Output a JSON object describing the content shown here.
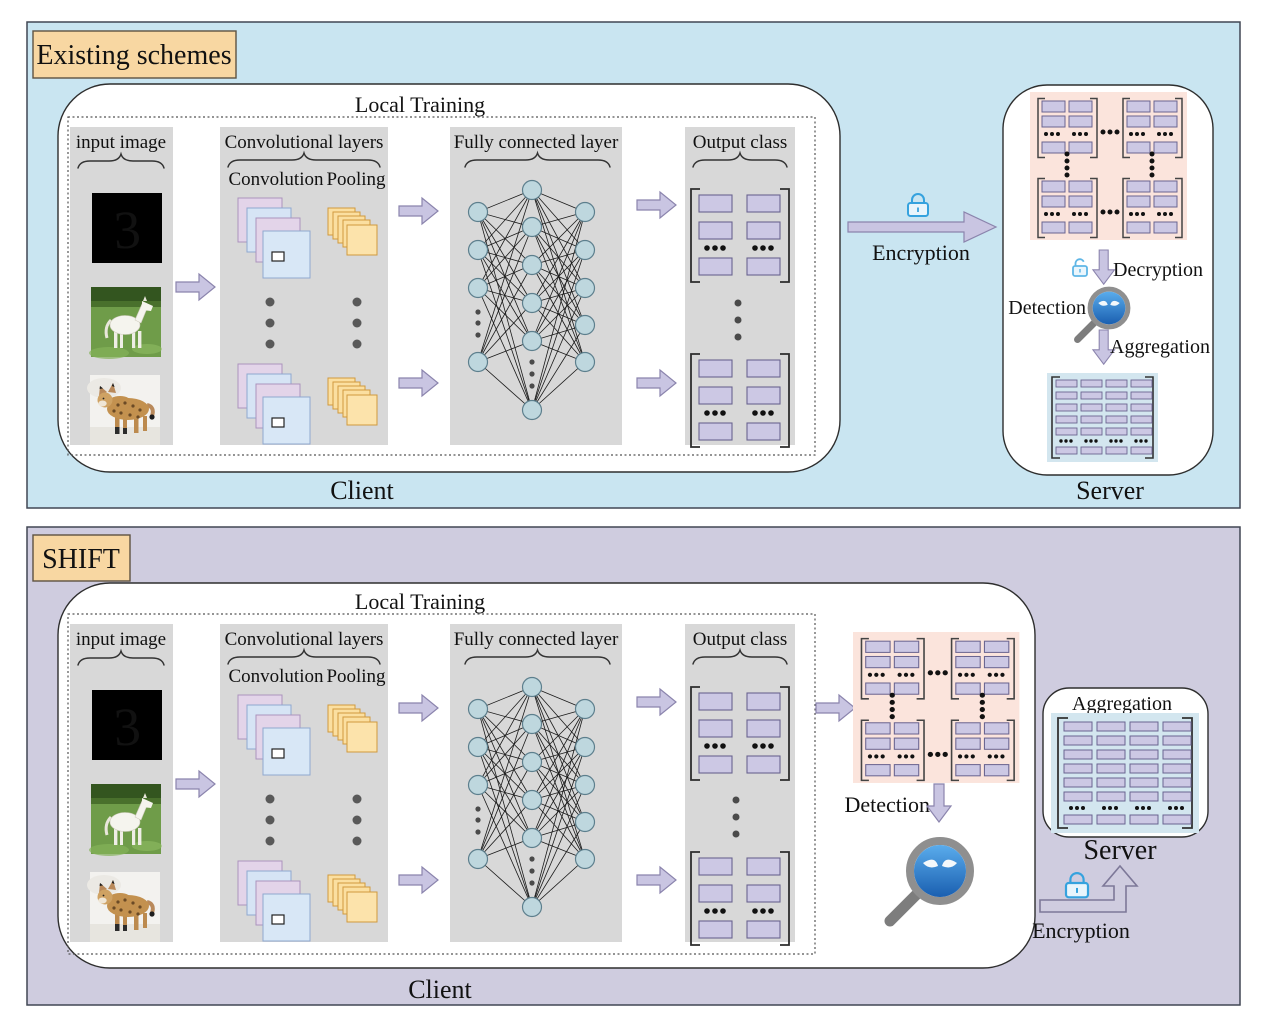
{
  "shared": {
    "mnist_digit": "3"
  },
  "panel1": {
    "tag": "Existing schemes",
    "local_training": "Local Training",
    "input_image": "input image",
    "conv_layers": "Convolutional layers",
    "convolution": "Convolution",
    "pooling": "Pooling",
    "fc_layer": "Fully connected layer",
    "output_class": "Output class",
    "client": "Client",
    "encryption": "Encryption",
    "decryption": "Decryption",
    "detection": "Detection",
    "aggregation": "Aggregation",
    "server": "Server"
  },
  "panel2": {
    "tag": "SHIFT",
    "local_training": "Local Training",
    "input_image": "input image",
    "conv_layers": "Convolutional layers",
    "convolution": "Convolution",
    "pooling": "Pooling",
    "fc_layer": "Fully connected layer",
    "output_class": "Output class",
    "client": "Client",
    "detection": "Detection",
    "aggregation": "Aggregation",
    "server": "Server",
    "encryption": "Encryption"
  },
  "colors": {
    "panel1_bg": "#c9e5f1",
    "panel2_bg": "#cfccdf",
    "tag_bg": "#f8d7a2",
    "stage_bg": "#d8d8d8",
    "arrow_fill": "#c9c5e2",
    "matrix_cell": "#ccc8e4",
    "encrypted_bg": "#fbe4dc",
    "aggregated_bg": "#d3e6ef",
    "lock_blue": "#35a2de",
    "conv_pink": "#e3d4e9",
    "conv_blue": "#d6e4f5",
    "pool_orange": "#fbdfa0",
    "neuron_fill": "#bed7de"
  }
}
